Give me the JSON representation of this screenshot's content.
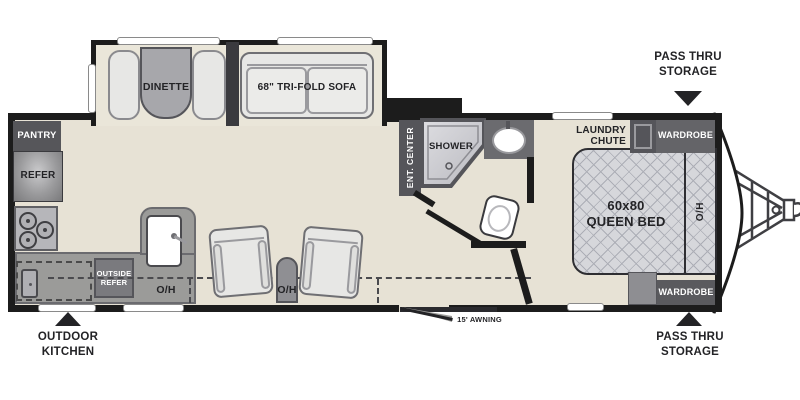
{
  "colors": {
    "floor": "#E7E2D5",
    "wall": "#1C1C1C",
    "cabinet_dark": "#55555A",
    "cabinet_mid": "#8F8F93",
    "counter": "#9B9B99",
    "upholstery": "#E7E7E5",
    "table": "#A7A7AB",
    "bed_fill": "#D6D7DB",
    "text_dark": "#232326",
    "text_light": "#FFFFFF"
  },
  "slideout": {
    "dinette_label": "DINETTE",
    "sofa_label": "68\" TRI-FOLD SOFA"
  },
  "kitchen": {
    "pantry_label": "PANTRY",
    "refer_label": "REFER",
    "outside_refer_line1": "OUTSIDE",
    "outside_refer_line2": "REFER",
    "overhead_label": "O/H"
  },
  "living": {
    "overhead_label": "O/H"
  },
  "bath": {
    "ent_center_label": "ENT. CENTER",
    "shower_label": "SHOWER"
  },
  "bedroom": {
    "laundry_chute_line1": "LAUNDRY",
    "laundry_chute_line2": "CHUTE",
    "wardrobe_top_label": "WARDROBE",
    "wardrobe_bottom_label": "WARDROBE",
    "bed_size_label": "60x80",
    "bed_type_label": "QUEEN BED",
    "overhead_label": "O/H"
  },
  "exterior": {
    "awning_label": "15' AWNING",
    "pass_thru_top_line1": "PASS THRU",
    "pass_thru_top_line2": "STORAGE",
    "pass_thru_bottom_line1": "PASS THRU",
    "pass_thru_bottom_line2": "STORAGE",
    "outdoor_kitchen_line1": "OUTDOOR",
    "outdoor_kitchen_line2": "KITCHEN"
  }
}
